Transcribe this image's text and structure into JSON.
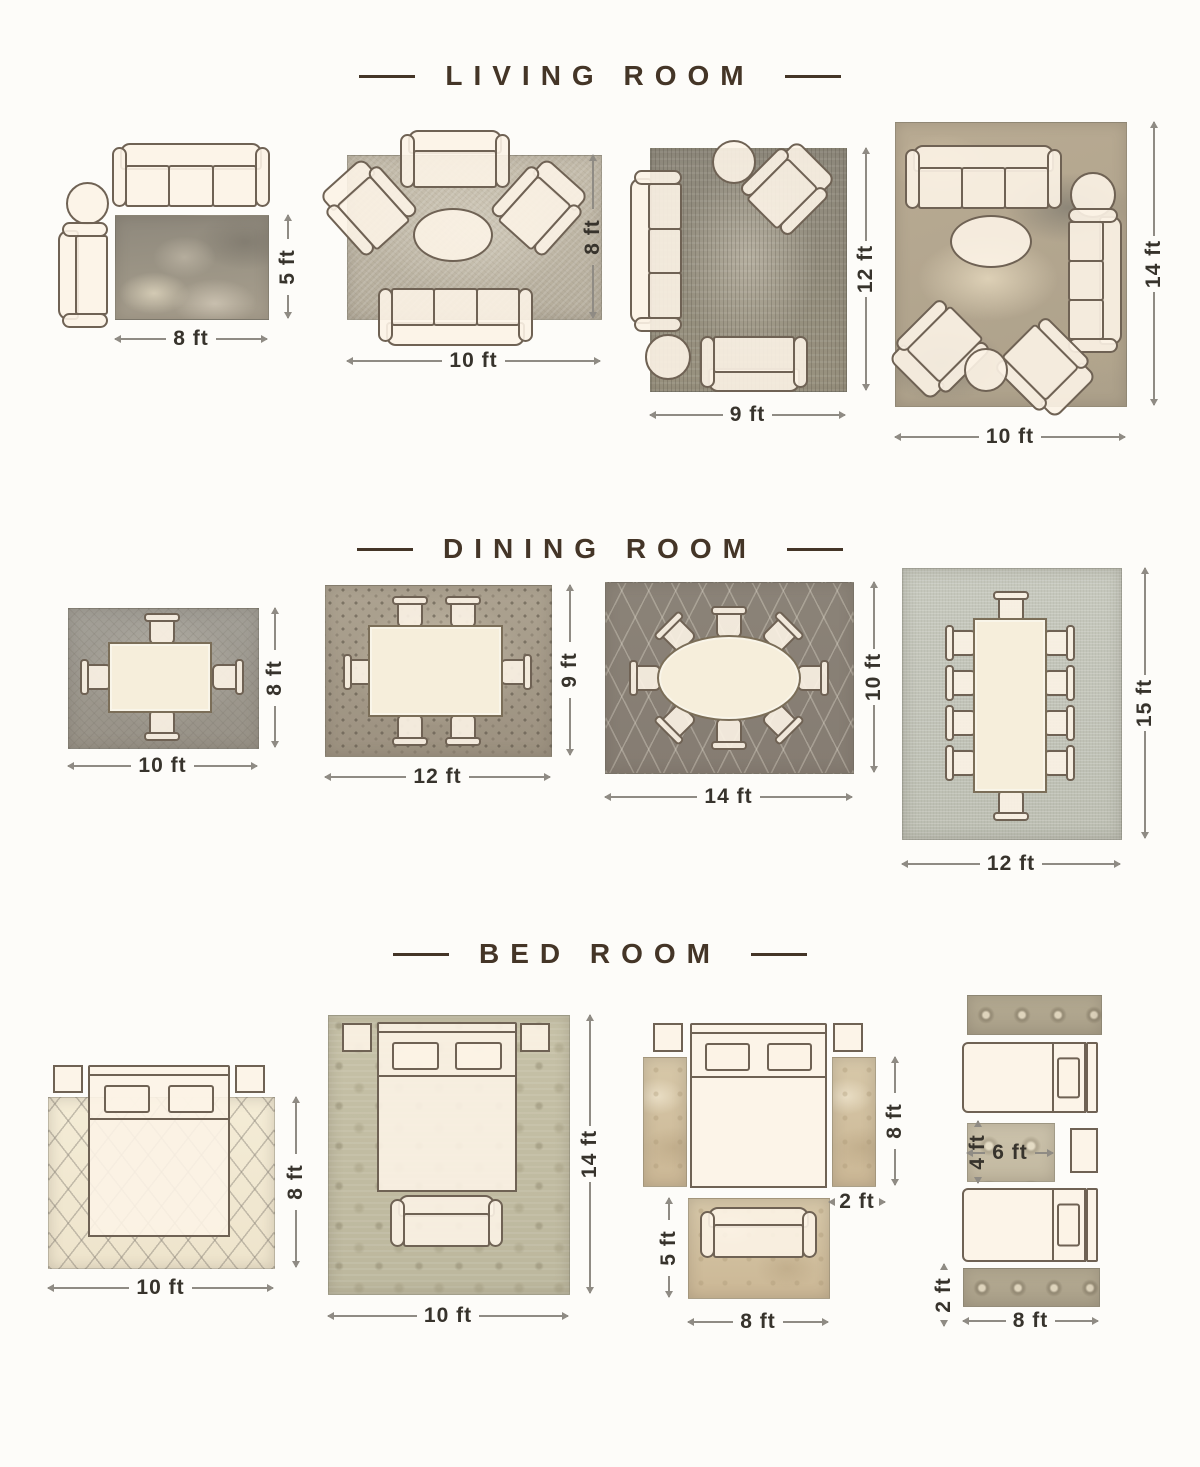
{
  "sections": [
    {
      "title": "LIVING ROOM",
      "layouts": [
        {
          "w": "8 ft",
          "h": "5 ft"
        },
        {
          "w": "10 ft",
          "h": "8 ft"
        },
        {
          "w": "9 ft",
          "h": "12 ft"
        },
        {
          "w": "10 ft",
          "h": "14 ft"
        }
      ]
    },
    {
      "title": "DINING ROOM",
      "layouts": [
        {
          "w": "10 ft",
          "h": "8 ft"
        },
        {
          "w": "12 ft",
          "h": "9 ft"
        },
        {
          "w": "14 ft",
          "h": "10 ft"
        },
        {
          "w": "12 ft",
          "h": "15 ft"
        }
      ]
    },
    {
      "title": "BED ROOM",
      "layouts": [
        {
          "w": "10 ft",
          "h": "8 ft"
        },
        {
          "w": "10 ft",
          "h": "14 ft"
        },
        {
          "side_h": "8 ft",
          "side_w": "2 ft",
          "foot_h": "5 ft",
          "foot_w": "8 ft"
        },
        {
          "mid_h": "4 ft",
          "mid_w": "6 ft",
          "runner_h": "2 ft",
          "w": "8 ft"
        }
      ]
    }
  ],
  "colors": {
    "title": "#443527",
    "furniture_outline": "#6f6254",
    "furniture_fill": "#fbf2e3",
    "dimension_text": "#37332c"
  }
}
